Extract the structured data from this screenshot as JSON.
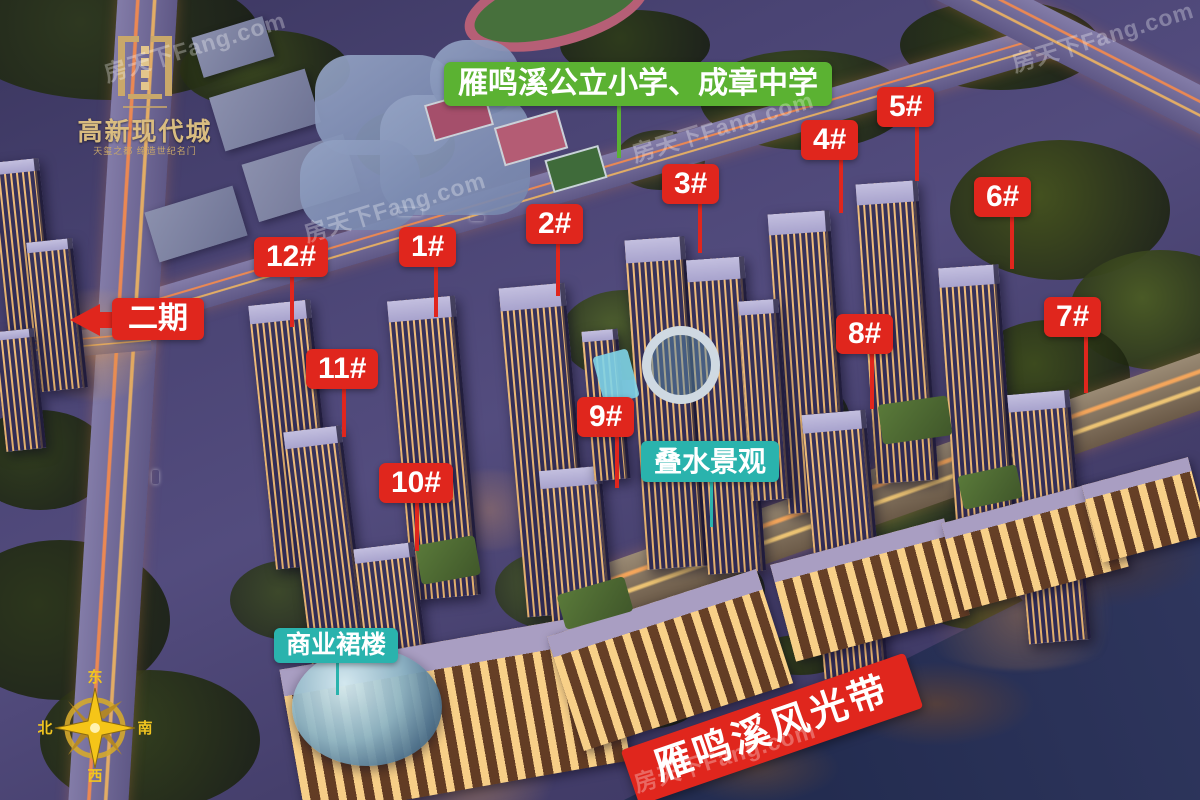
{
  "logo": {
    "title": "高新现代城",
    "tagline": "天玺之都 缔造世纪名门"
  },
  "labels": {
    "school": "雁鸣溪公立小学、成章中学",
    "phase2": "二期",
    "water_feature": "叠水景观",
    "commercial_podium": "商业裙楼",
    "river_banner": "雁鸣溪风光带"
  },
  "buildings": [
    {
      "label": "1#"
    },
    {
      "label": "2#"
    },
    {
      "label": "3#"
    },
    {
      "label": "4#"
    },
    {
      "label": "5#"
    },
    {
      "label": "6#"
    },
    {
      "label": "7#"
    },
    {
      "label": "8#"
    },
    {
      "label": "9#"
    },
    {
      "label": "10#"
    },
    {
      "label": "11#"
    },
    {
      "label": "12#"
    }
  ],
  "compass": {
    "top": "东",
    "right": "南",
    "bottom": "西",
    "left": "北"
  },
  "watermark": "房天下Fang.com",
  "colors": {
    "label_red": "#e0261d",
    "label_green": "#5bb232",
    "label_teal": "#2ab3ad",
    "logo_gold": "#d9bc80",
    "compass_gold": "#f0c420"
  }
}
